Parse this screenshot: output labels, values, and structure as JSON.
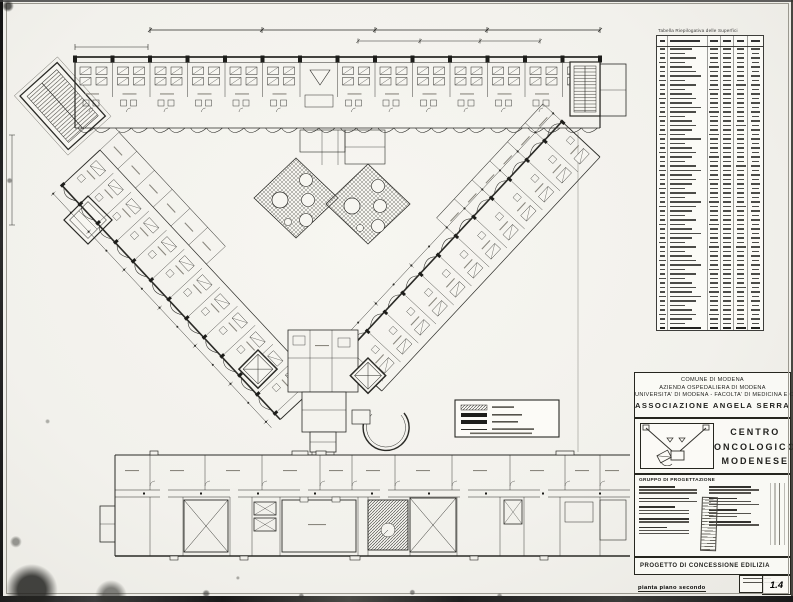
{
  "surface_table": {
    "title": "Tabella Riepilogativa delle Superfici",
    "visible_rows": 63,
    "columns": 6
  },
  "title_block": {
    "org_lines": [
      "COMUNE DI MODENA",
      "AZIENDA OSPEDALIERA DI MODENA",
      "UNIVERSITA' DI MODENA - FACOLTA' DI MEDICINA E CHIRURGIA",
      "ASSOCIAZIONE ANGELA SERRA"
    ],
    "project_lines": [
      "CENTRO",
      "ONCOLOGICO",
      "MODENESE"
    ],
    "team_header": "GRUPPO DI PROGETTAZIONE",
    "doc_type": "PROGETTO DI CONCESSIONE EDILIZIA",
    "drawing_caption": "pianta piano secondo",
    "drawing_number": "1.4"
  },
  "icons": {
    "logo": "building-schematic-icon"
  },
  "colors": {
    "paper": "#f2f1ec",
    "ink": "#262622"
  }
}
